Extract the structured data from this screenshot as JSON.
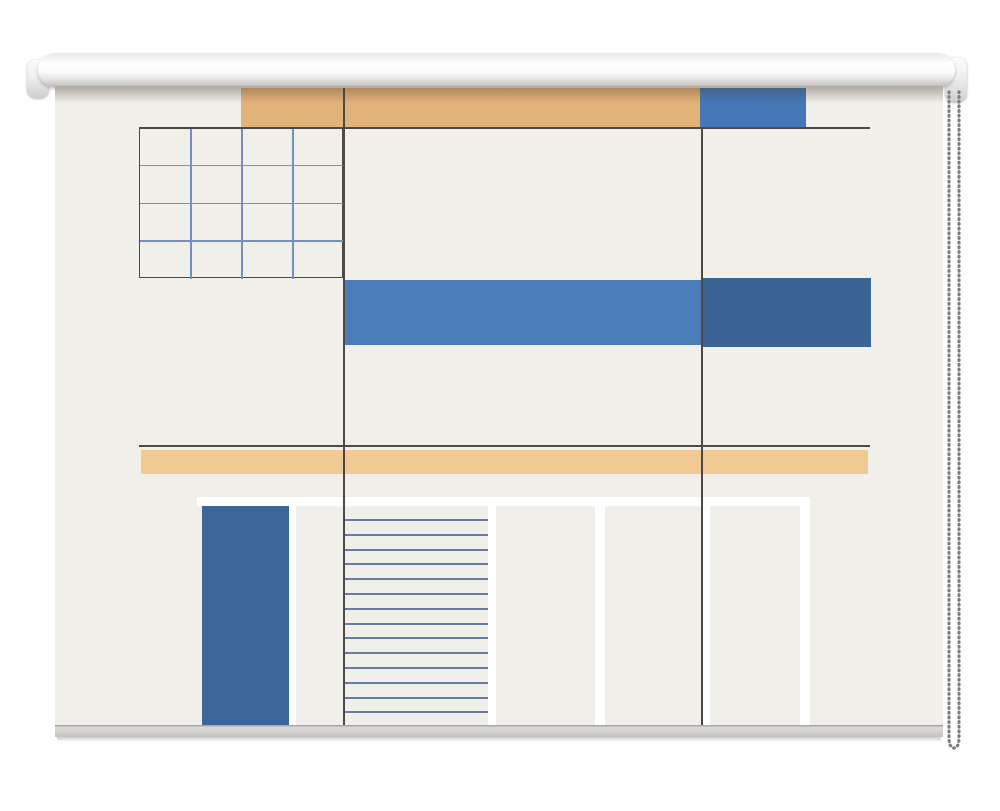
{
  "scene": {
    "name": "roller-blind-product-photo",
    "description": "White roller blind mockup printed with an abstract modernist building facade (tan and blue rectangles, blue grid, striped shutter) on a plain white background, beaded pull chain on the right side",
    "background_color": "#ffffff"
  },
  "roller": {
    "tube_color": "#fbfbfb",
    "cap_color": "#efefef"
  },
  "fabric": {
    "base_color": "#f1efea",
    "hem_color": "#c9c7c2"
  },
  "chain": {
    "bead_color": "#7e7e7e",
    "cord_color": "#cccccc",
    "bead_pitch": "0.6 4.1"
  },
  "artwork": {
    "palette": {
      "tan_dark": "#e2b379",
      "tan_light": "#f1ca93",
      "blue_mid": "#4477b5",
      "blue_light": "#4a7cb7",
      "blue_dark": "#3b6394",
      "blue_door": "#39669b",
      "line_dark": "#4b4a43",
      "line_blue": "#7590bf",
      "stripe_blue": "#667ca6",
      "white": "#ffffff"
    },
    "rects": [
      {
        "name": "band-top-tan",
        "x": 186,
        "y": 2,
        "w": 459,
        "h": 40,
        "color": "#e2b379"
      },
      {
        "name": "band-top-blue",
        "x": 645,
        "y": 2,
        "w": 106,
        "h": 40,
        "color": "#4477b5"
      },
      {
        "name": "band-mid-light-blue",
        "x": 288,
        "y": 194,
        "w": 358,
        "h": 65,
        "color": "#4a7cb7"
      },
      {
        "name": "band-mid-dark-blue",
        "x": 646,
        "y": 192,
        "w": 170,
        "h": 69,
        "color": "#3b6394"
      },
      {
        "name": "band-lower-tan",
        "x": 86,
        "y": 364,
        "w": 727,
        "h": 24,
        "color": "#f1ca93"
      },
      {
        "name": "facade-white-band",
        "x": 142,
        "y": 411,
        "w": 613,
        "h": 9,
        "color": "#ffffff"
      },
      {
        "name": "door-panel-blue",
        "x": 147,
        "y": 420,
        "w": 87,
        "h": 220,
        "color": "#39669b"
      },
      {
        "name": "facade-white-bar-1",
        "x": 234,
        "y": 420,
        "w": 7,
        "h": 220,
        "color": "#ffffff"
      },
      {
        "name": "facade-white-bar-2",
        "x": 433,
        "y": 420,
        "w": 8,
        "h": 220,
        "color": "#ffffff"
      },
      {
        "name": "facade-white-bar-3",
        "x": 540,
        "y": 420,
        "w": 10,
        "h": 220,
        "color": "#ffffff"
      },
      {
        "name": "facade-white-bar-4",
        "x": 646,
        "y": 420,
        "w": 9,
        "h": 220,
        "color": "#ffffff"
      },
      {
        "name": "facade-white-bar-5",
        "x": 745,
        "y": 420,
        "w": 10,
        "h": 220,
        "color": "#ffffff"
      }
    ],
    "lines": [
      {
        "name": "h-rule-top",
        "x": 84,
        "y": 41,
        "length": 731,
        "orient": "h",
        "color": "#4b4a43",
        "thickness": 1.5
      },
      {
        "name": "h-rule-middle",
        "x": 84,
        "y": 359,
        "length": 731,
        "orient": "h",
        "color": "#4b4a43",
        "thickness": 1.5
      },
      {
        "name": "v-rule-left",
        "x": 288,
        "y": 2,
        "length": 642,
        "orient": "v",
        "color": "#4b4a43",
        "thickness": 1.5
      },
      {
        "name": "v-rule-right",
        "x": 646,
        "y": 41,
        "length": 599,
        "orient": "v",
        "color": "#4b4a43",
        "thickness": 1.5
      }
    ],
    "grid": {
      "name": "print-grid",
      "x": 84,
      "y": 41,
      "w": 204,
      "h": 151,
      "cols": 4,
      "rows": 4,
      "outer_color": "#4b4a43",
      "inner_color": "#7590bf",
      "line_thickness": 1.5
    },
    "stripes": {
      "name": "shutter-stripes",
      "x": 290,
      "y_start": 433,
      "width": 143,
      "step": 14.8,
      "count": 15,
      "thickness": 2,
      "color": "#667ca6"
    }
  }
}
